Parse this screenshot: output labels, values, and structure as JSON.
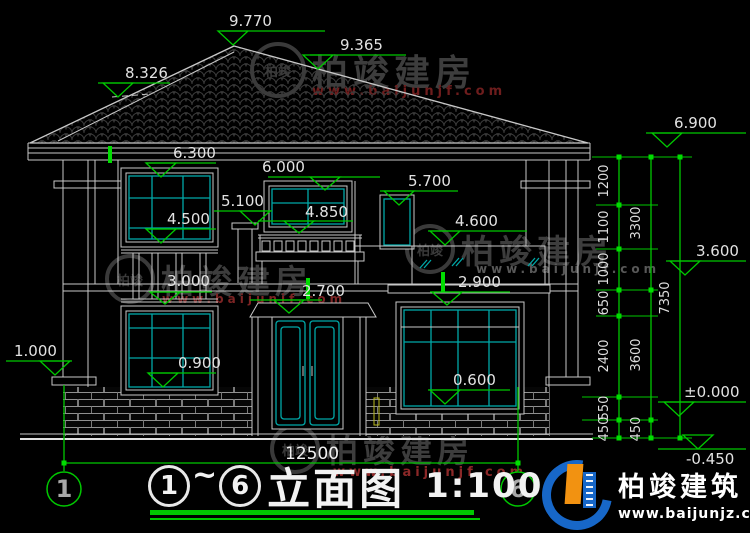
{
  "levels": {
    "peak": "9.770",
    "ridge_right": "9.365",
    "ridge_left": "8.326",
    "eave": "6.900",
    "left_win_top": "6.300",
    "balcony_win_top": "6.000",
    "right_win_top": "5.700",
    "porch_top": "5.100",
    "balcony_sill": "4.850",
    "right_band": "4.600",
    "left_win_sill": "4.500",
    "floor2": "3.600",
    "left_rail": "3.000",
    "right_win1_top": "2.900",
    "door_top": "2.700",
    "side_ledge": "1.000",
    "left_sill1": "0.900",
    "right_sill1": "0.600",
    "zero": "±0.000",
    "ground": "-0.450"
  },
  "chain_a": [
    "1200",
    "1100",
    "1000",
    "650",
    "2400",
    "550",
    "450"
  ],
  "chain_b": [
    "3300",
    "3600",
    "450"
  ],
  "chain_c": "7350",
  "width_total": "12500",
  "axis": {
    "left": "1",
    "right": "6"
  },
  "title": {
    "axis_from": "1",
    "separator": "~",
    "axis_to": "6",
    "name": "立面图",
    "scale": "1:100"
  },
  "watermark": {
    "monogram": "柏竣",
    "name": "柏竣建房",
    "url": "www.baijunjf.com"
  },
  "brand": {
    "name": "柏竣建筑",
    "url": "www.baijunjz.com"
  }
}
